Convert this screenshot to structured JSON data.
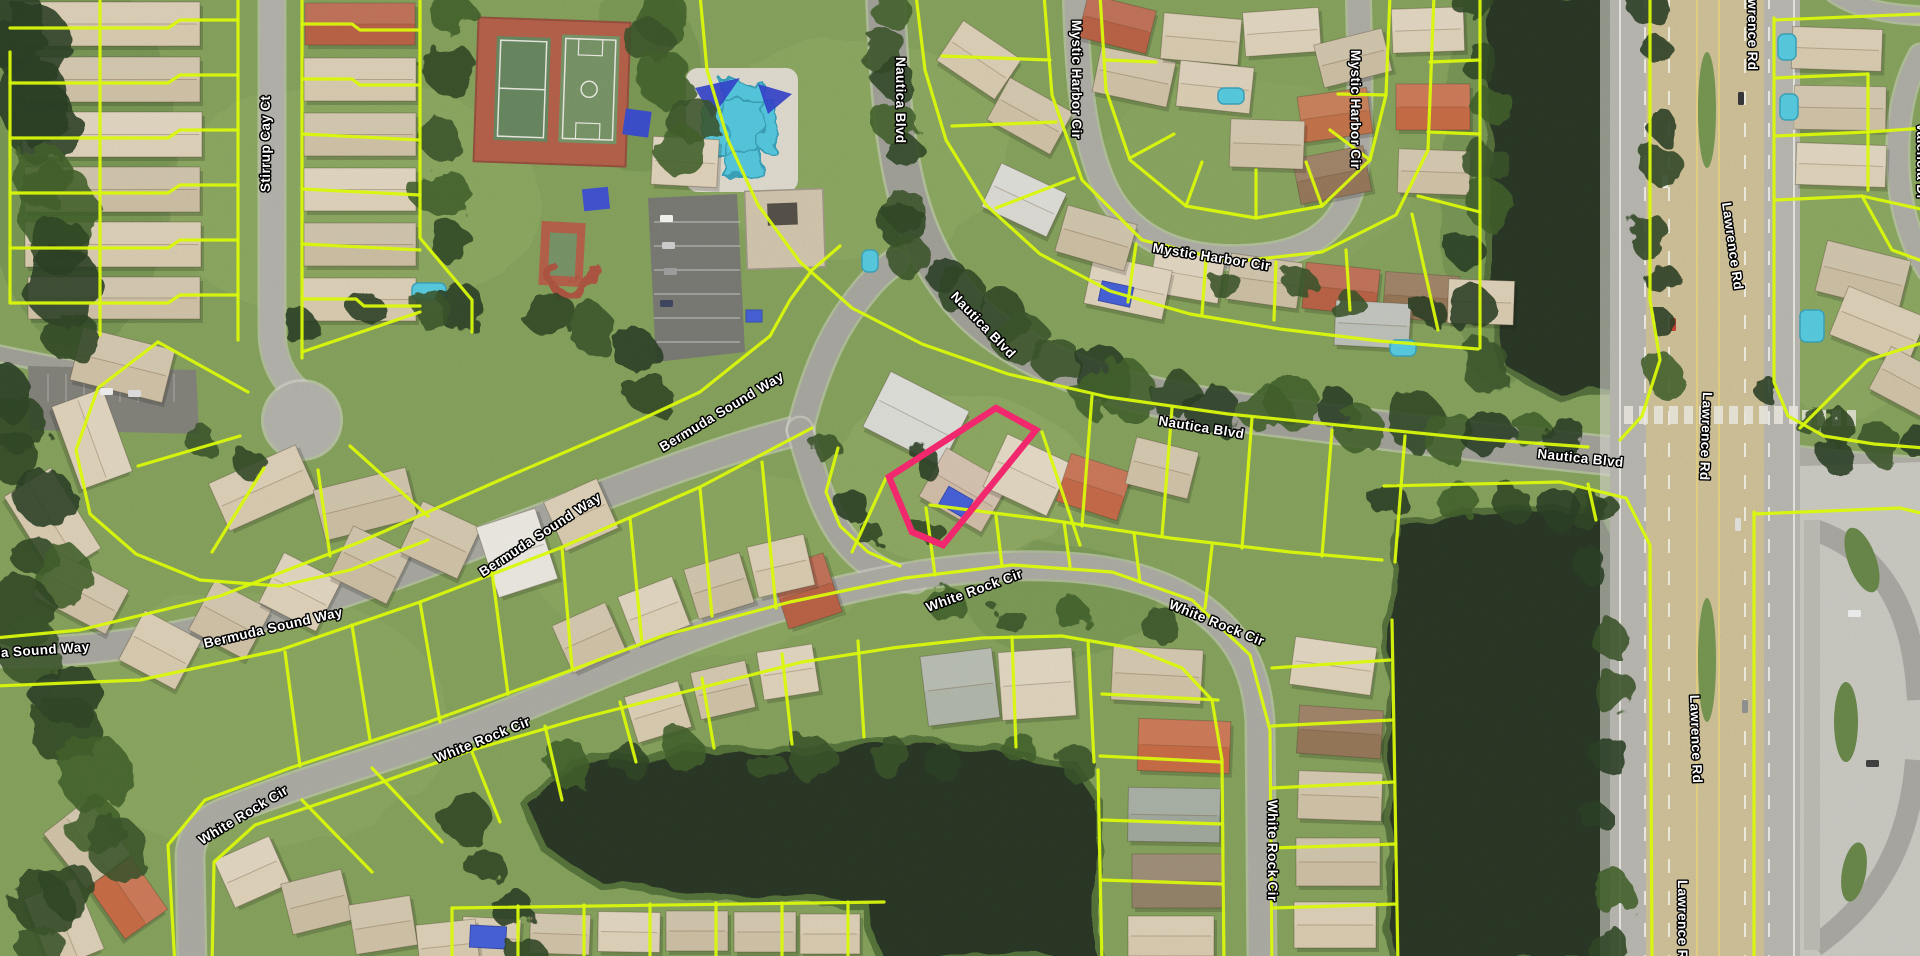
{
  "map": {
    "streets": {
      "stirrup_cay_ct": "Stirrup Cay Ct",
      "bermuda_sound_way": "Bermuda Sound Way",
      "nautica_blvd": "Nautica Blvd",
      "mystic_harbor_cir": "Mystic Harbor Cir",
      "white_rock_cir": "White Rock Cir",
      "lawrence_rd": "Lawrence Rd",
      "valencia_dr": "Valencia Dr"
    },
    "highlight": {
      "color": "#f1286d"
    },
    "colors": {
      "parcel_line": "#d9f80b",
      "water": "#1c2a12",
      "road_asphalt": "#a6a69e",
      "lawrence_center": "#cbbc90",
      "grass": "#7d9c51"
    }
  }
}
